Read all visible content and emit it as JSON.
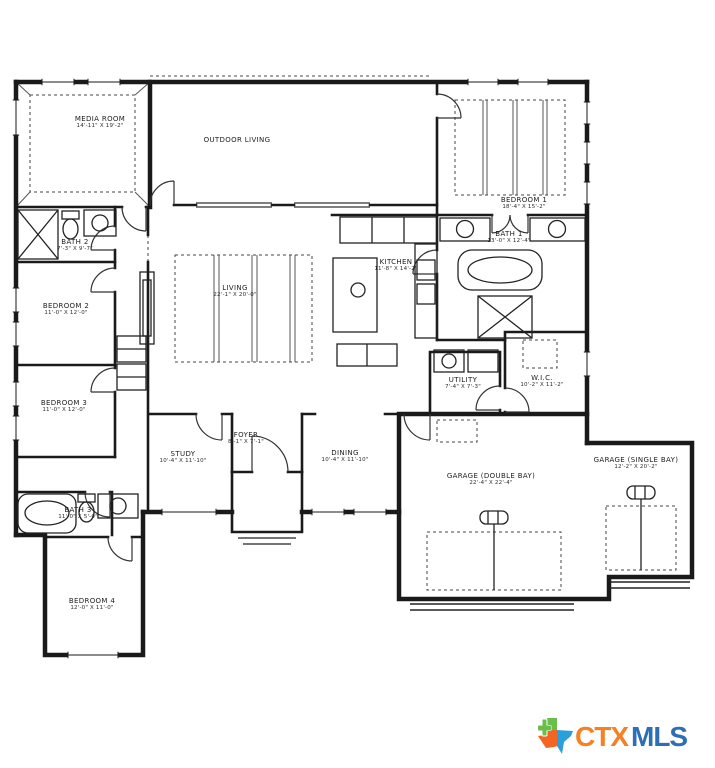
{
  "rooms": [
    {
      "name": "MEDIA ROOM",
      "dims": "14'-11\" X 19'-2\""
    },
    {
      "name": "OUTDOOR LIVING",
      "dims": ""
    },
    {
      "name": "BEDROOM 1",
      "dims": "18'-4\" X 15'-2\""
    },
    {
      "name": "BATH 2",
      "dims": "7'-3\" X 9'-7\""
    },
    {
      "name": "BATH 1",
      "dims": "13'-0\" X 12'-4\""
    },
    {
      "name": "BEDROOM 2",
      "dims": "11'-0\" X 12'-0\""
    },
    {
      "name": "LIVING",
      "dims": "22'-1\" X 20'-0\""
    },
    {
      "name": "KITCHEN",
      "dims": "11'-8\" X 14'-2\""
    },
    {
      "name": "BEDROOM 3",
      "dims": "11'-0\" X 12'-0\""
    },
    {
      "name": "UTILITY",
      "dims": "7'-4\" X 7'-3\""
    },
    {
      "name": "W.I.C.",
      "dims": "10'-2\" X 11'-2\""
    },
    {
      "name": "STUDY",
      "dims": "10'-4\" X 11'-10\""
    },
    {
      "name": "FOYER",
      "dims": "8'-1\" X 7'-1\""
    },
    {
      "name": "DINING",
      "dims": "10'-4\" X 11'-10\""
    },
    {
      "name": "GARAGE (DOUBLE BAY)",
      "dims": "22'-4\" X 22'-4\""
    },
    {
      "name": "GARAGE (SINGLE BAY)",
      "dims": "12'-2\" X 20'-2\""
    },
    {
      "name": "BATH 3",
      "dims": "11'-0\" X 5'-0\""
    },
    {
      "name": "BEDROOM 4",
      "dims": "12'-0\" X 11'-0\""
    }
  ],
  "logo": {
    "ctx": "CTX",
    "mls": "MLS",
    "ctx_color": "#F58025",
    "mls_color": "#2D6EB5",
    "texas_green": "#6ABF4B",
    "texas_orange": "#F26522",
    "texas_blue": "#2B9FD9"
  }
}
